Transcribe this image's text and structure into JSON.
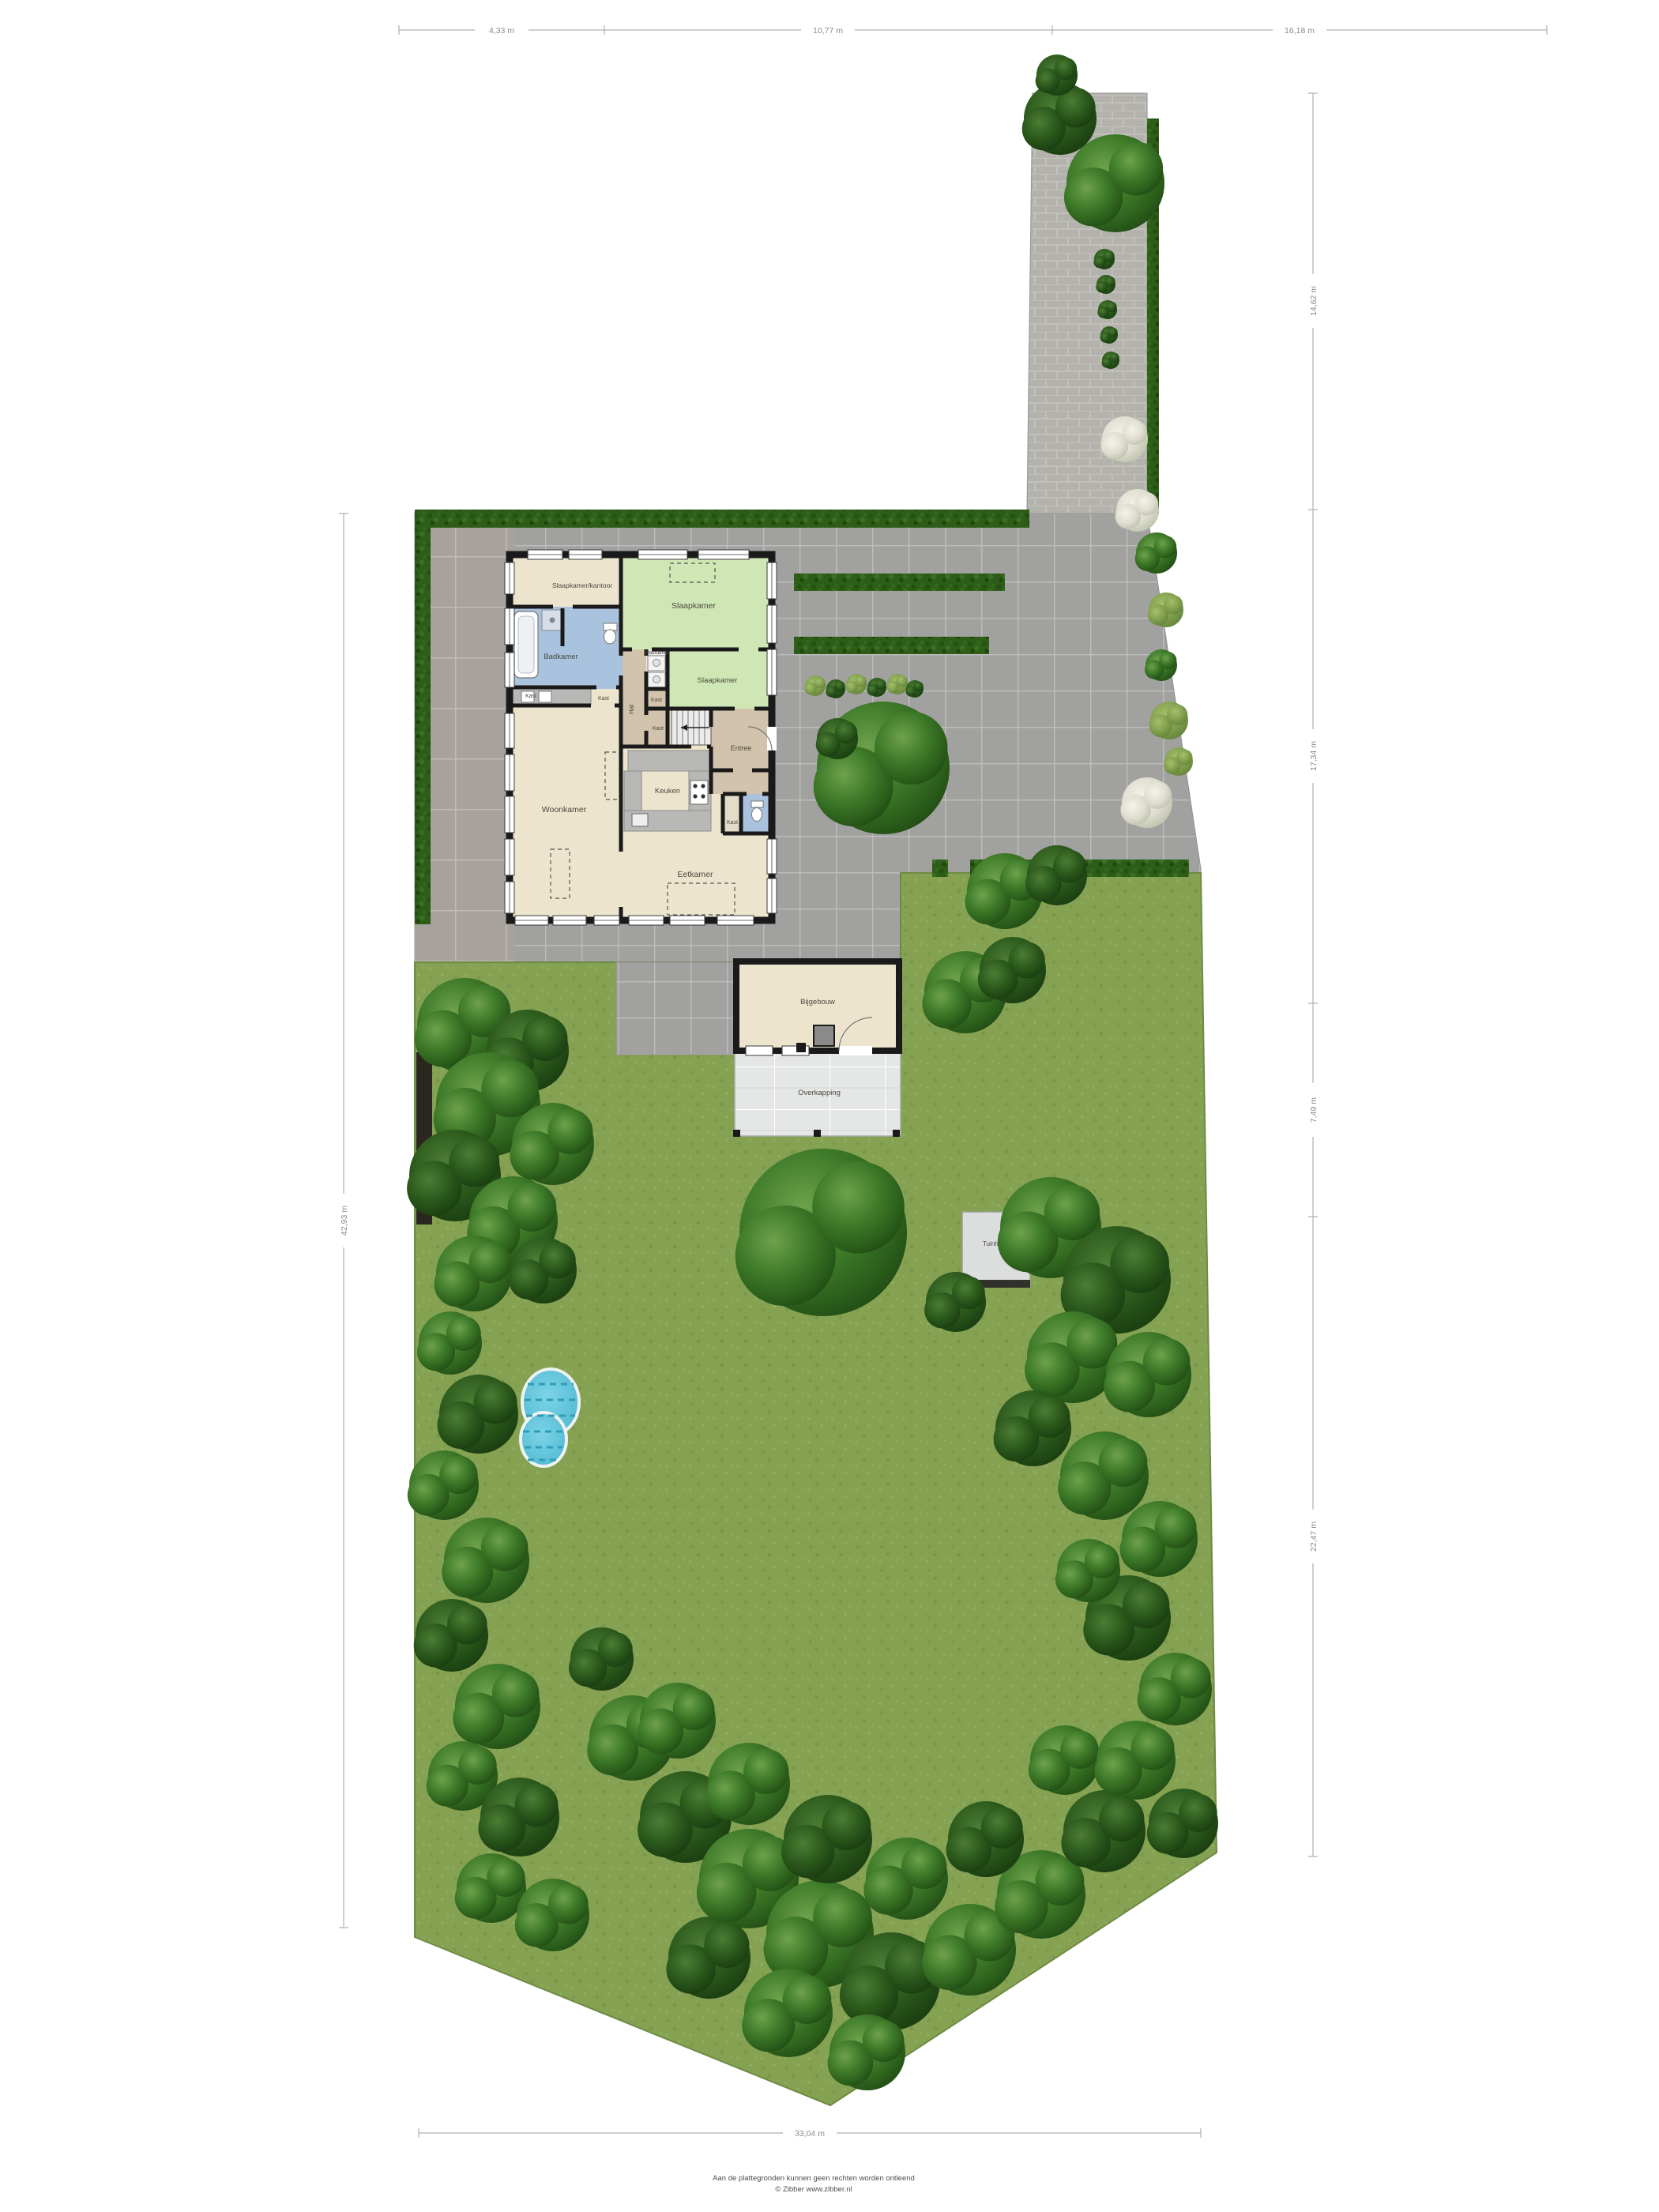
{
  "plan": {
    "rooms": {
      "slaapkamer_kantoor": "Slaapkamer/kantoor",
      "badkamer": "Badkamer",
      "slaapkamer_1": "Slaapkamer",
      "slaapkamer_2": "Slaapkamer",
      "wasruimte": "Wasruimte",
      "hal": "Hal",
      "kast": "Kast",
      "entree": "Entree",
      "woonkamer": "Woonkamer",
      "keuken": "Keuken",
      "eetkamer": "Eetkamer"
    },
    "outbuilding": {
      "room": "Bijgebouw",
      "canopy": "Overkapping"
    },
    "garden": {
      "shed": "Tuinhuis"
    },
    "dimensions": {
      "top": [
        "4,33 m",
        "10,77 m",
        "16,18 m"
      ],
      "right": [
        "14,62 m",
        "17,34 m",
        "7,49 m",
        "22,47 m"
      ],
      "left": "42,93 m",
      "bottom": "33,04 m"
    },
    "footer": {
      "disclaimer": "Aan de plattegronden kunnen geen rechten worden ontleend",
      "credit": "© Zibber www.zibber.nl"
    },
    "colors": {
      "grass": "#85a253",
      "paving": "#a1a1a0",
      "hedge": "#2d5d18",
      "room_beige": "#ece4cd",
      "room_green": "#cfe7b5",
      "room_blue": "#a9c2de",
      "room_tan": "#d2c3ac",
      "pool": "#5fc3da"
    }
  }
}
